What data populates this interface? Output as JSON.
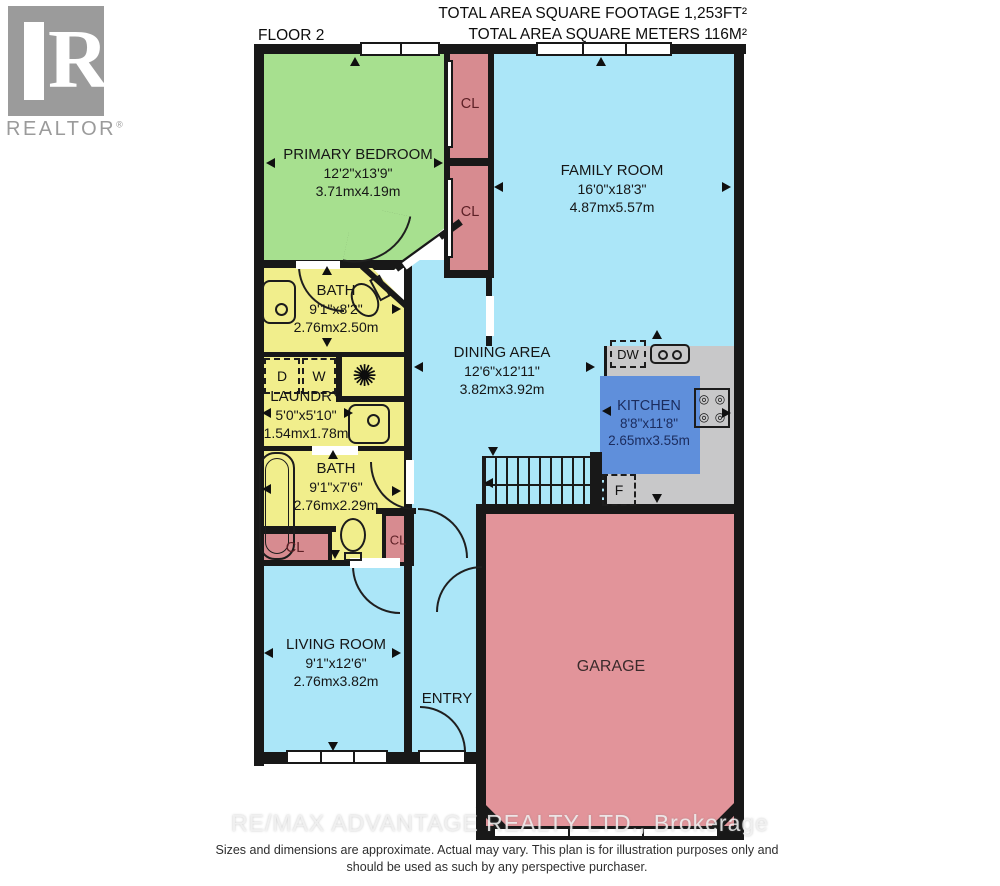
{
  "header": {
    "floor": "FLOOR 2",
    "area_ft": "TOTAL AREA SQUARE FOOTAGE 1,253FT²",
    "area_m": "TOTAL AREA SQUARE METERS 116M²"
  },
  "logo": {
    "letter": "R",
    "text": "REALTOR",
    "reg": "®"
  },
  "rooms": {
    "primary_bedroom": {
      "name": "PRIMARY BEDROOM",
      "imperial": "12'2\"x13'9\"",
      "metric": "3.71mx4.19m"
    },
    "family_room": {
      "name": "FAMILY ROOM",
      "imperial": "16'0\"x18'3\"",
      "metric": "4.87mx5.57m"
    },
    "bath_upper": {
      "name": "BATH",
      "imperial": "9'1\"x8'2\"",
      "metric": "2.76mx2.50m"
    },
    "laundry": {
      "name": "LAUNDRY",
      "imperial": "5'0\"x5'10\"",
      "metric": "1.54mx1.78m"
    },
    "dining": {
      "name": "DINING AREA",
      "imperial": "12'6\"x12'11\"",
      "metric": "3.82mx3.92m"
    },
    "kitchen": {
      "name": "KITCHEN",
      "imperial": "8'8\"x11'8\"",
      "metric": "2.65mx3.55m"
    },
    "bath_lower": {
      "name": "BATH",
      "imperial": "9'1\"x7'6\"",
      "metric": "2.76mx2.29m"
    },
    "living_room": {
      "name": "LIVING ROOM",
      "imperial": "9'1\"x12'6\"",
      "metric": "2.76mx3.82m"
    },
    "entry": {
      "name": "ENTRY"
    },
    "garage": {
      "name": "GARAGE"
    }
  },
  "labels": {
    "closet": "CL",
    "dryer": "D",
    "washer": "W",
    "dishwasher": "DW",
    "fridge": "F"
  },
  "icons": {
    "fan": "✺",
    "burner": "◎"
  },
  "footer": {
    "watermark": "RE/MAX ADVANTAGE REALTY LTD., Brokerage",
    "disclaimer1": "Sizes and dimensions are approximate. Actual may vary. This plan is for illustration purposes only and",
    "disclaimer2": "should be used as such by any perspective purchaser."
  },
  "colors": {
    "bedroom": "#a7e08f",
    "bath": "#f1ee8c",
    "blue_room": "#abe6f8",
    "closet": "#d78b90",
    "garage": "#e2949a",
    "kitchen_area": "#c8c8c9",
    "kitchen_box": "#5f8fdb",
    "wall": "#181818"
  }
}
